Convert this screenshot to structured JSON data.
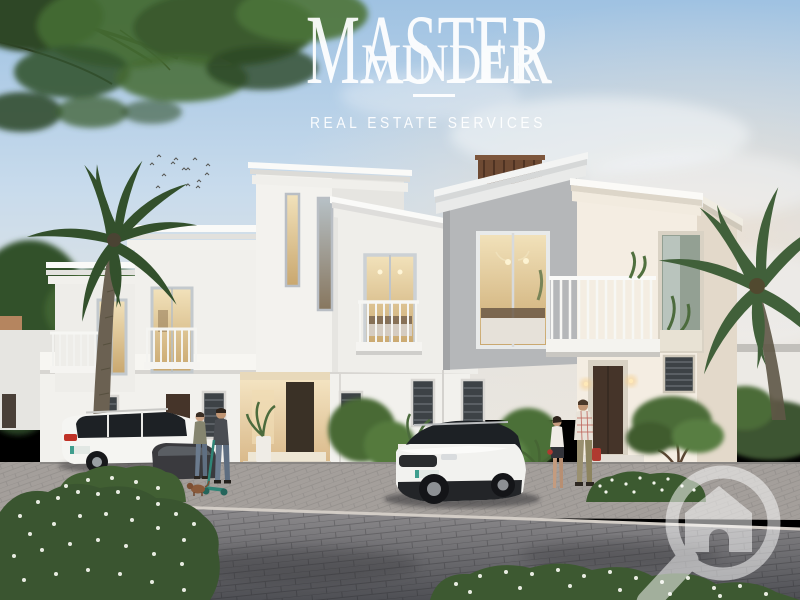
{
  "brand": {
    "line1": "MASTER",
    "line2": "MINDER",
    "tagline": "REAL ESTATE SERVICES",
    "text_color": "#ffffff"
  },
  "watermark": {
    "icon": "magnifier-house-watermark-icon",
    "color": "#ffffff",
    "opacity": "0.52"
  },
  "palette": {
    "sky_top": "#9fc2e2",
    "sky_mid": "#c8dbec",
    "sky_low": "#e2e4e3",
    "sky_warm": "#f0e2d2",
    "cloud_white": "#f4f7f9",
    "building_white": "#f2f1ed",
    "building_warm": "#f4ede2",
    "building_shade": "#e0dfdb",
    "building_gray": "#b5b7b9",
    "cornice_white": "#f7f7f4",
    "window_frame": "#c3c9cd",
    "window_warm_hi": "#f2e2bb",
    "window_warm_lo": "#c9a76e",
    "door_brown": "#453429",
    "shutter_dark": "#3d4246",
    "pergola_wood": "#6e4a33",
    "pavement_walkway": "#a49f9b",
    "pavement_drive_hi": "#8f8d8f",
    "pavement_drive_lo": "#4e4f54",
    "curb_light": "#d3cdc6",
    "foliage_dark": "#2d4727",
    "foliage_mid": "#456b34",
    "foliage_light": "#5c8241",
    "palm_green": "#33502c",
    "trunk_brown": "#6b6152",
    "flower_white": "#f3f5ec",
    "car_white": "#f5f5f2",
    "car_glass": "#1d2125",
    "car_dark": "#3a3a3e",
    "taillight_red": "#c03227",
    "plate_teal": "#3f9e8e",
    "scooter_teal": "#2f8577",
    "bag_red": "#b03a30",
    "dog_brown": "#8a5a3a",
    "jeans_blue": "#6b7b8e",
    "khaki": "#9a9070"
  }
}
